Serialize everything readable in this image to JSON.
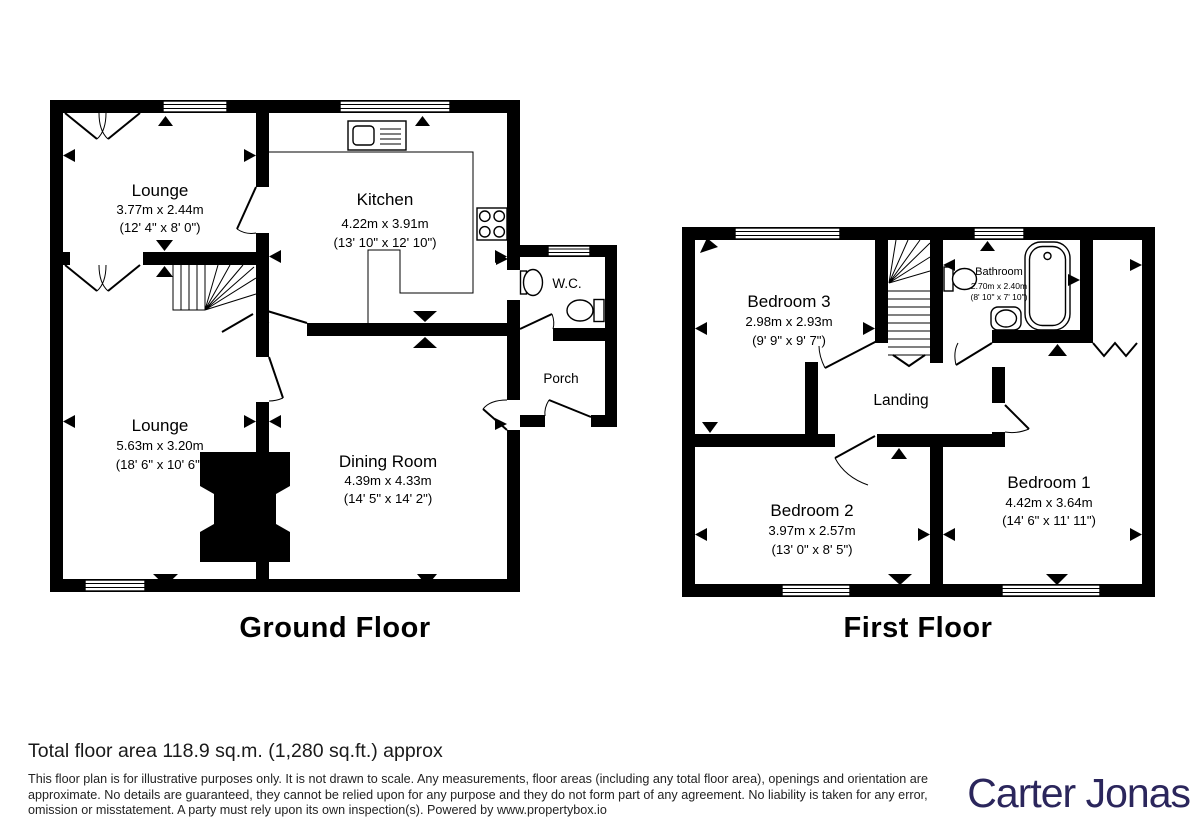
{
  "ground": {
    "title": "Ground Floor",
    "lounge_top": {
      "name": "Lounge",
      "m": "3.77m x 2.44m",
      "ft": "(12' 4\" x 8' 0\")"
    },
    "kitchen": {
      "name": "Kitchen",
      "m": "4.22m x 3.91m",
      "ft": "(13' 10\" x 12' 10\")"
    },
    "wc": {
      "name": "W.C."
    },
    "porch": {
      "name": "Porch"
    },
    "lounge_main": {
      "name": "Lounge",
      "m": "5.63m x 3.20m",
      "ft": "(18' 6\" x 10' 6\")"
    },
    "dining": {
      "name": "Dining Room",
      "m": "4.39m x 4.33m",
      "ft": "(14' 5\" x 14' 2\")"
    }
  },
  "first": {
    "title": "First Floor",
    "bedroom3": {
      "name": "Bedroom 3",
      "m": "2.98m x 2.93m",
      "ft": "(9' 9\" x 9' 7\")"
    },
    "bathroom": {
      "name": "Bathroom",
      "m": "2.70m x 2.40m",
      "ft": "(8' 10\" x 7' 10\")"
    },
    "landing": {
      "name": "Landing"
    },
    "bedroom2": {
      "name": "Bedroom 2",
      "m": "3.97m x 2.57m",
      "ft": "(13' 0\" x 8' 5\")"
    },
    "bedroom1": {
      "name": "Bedroom 1",
      "m": "4.42m x 3.64m",
      "ft": "(14' 6\" x 11' 11\")"
    }
  },
  "footer": {
    "total_area": "Total floor area 118.9 sq.m. (1,280 sq.ft.) approx",
    "disclaimer": "This floor plan is for illustrative purposes only. It is not drawn to scale. Any measurements, floor areas (including any total floor area), openings and orientation are approximate. No details are guaranteed, they cannot be relied upon for any purpose and they do not form part of any agreement. No liability is taken for any error, omission or misstatement. A party must rely upon its own inspection(s). Powered by www.propertybox.io",
    "brand": "Carter Jonas",
    "brand_color": "#2b265c",
    "line_color": "#000000"
  }
}
